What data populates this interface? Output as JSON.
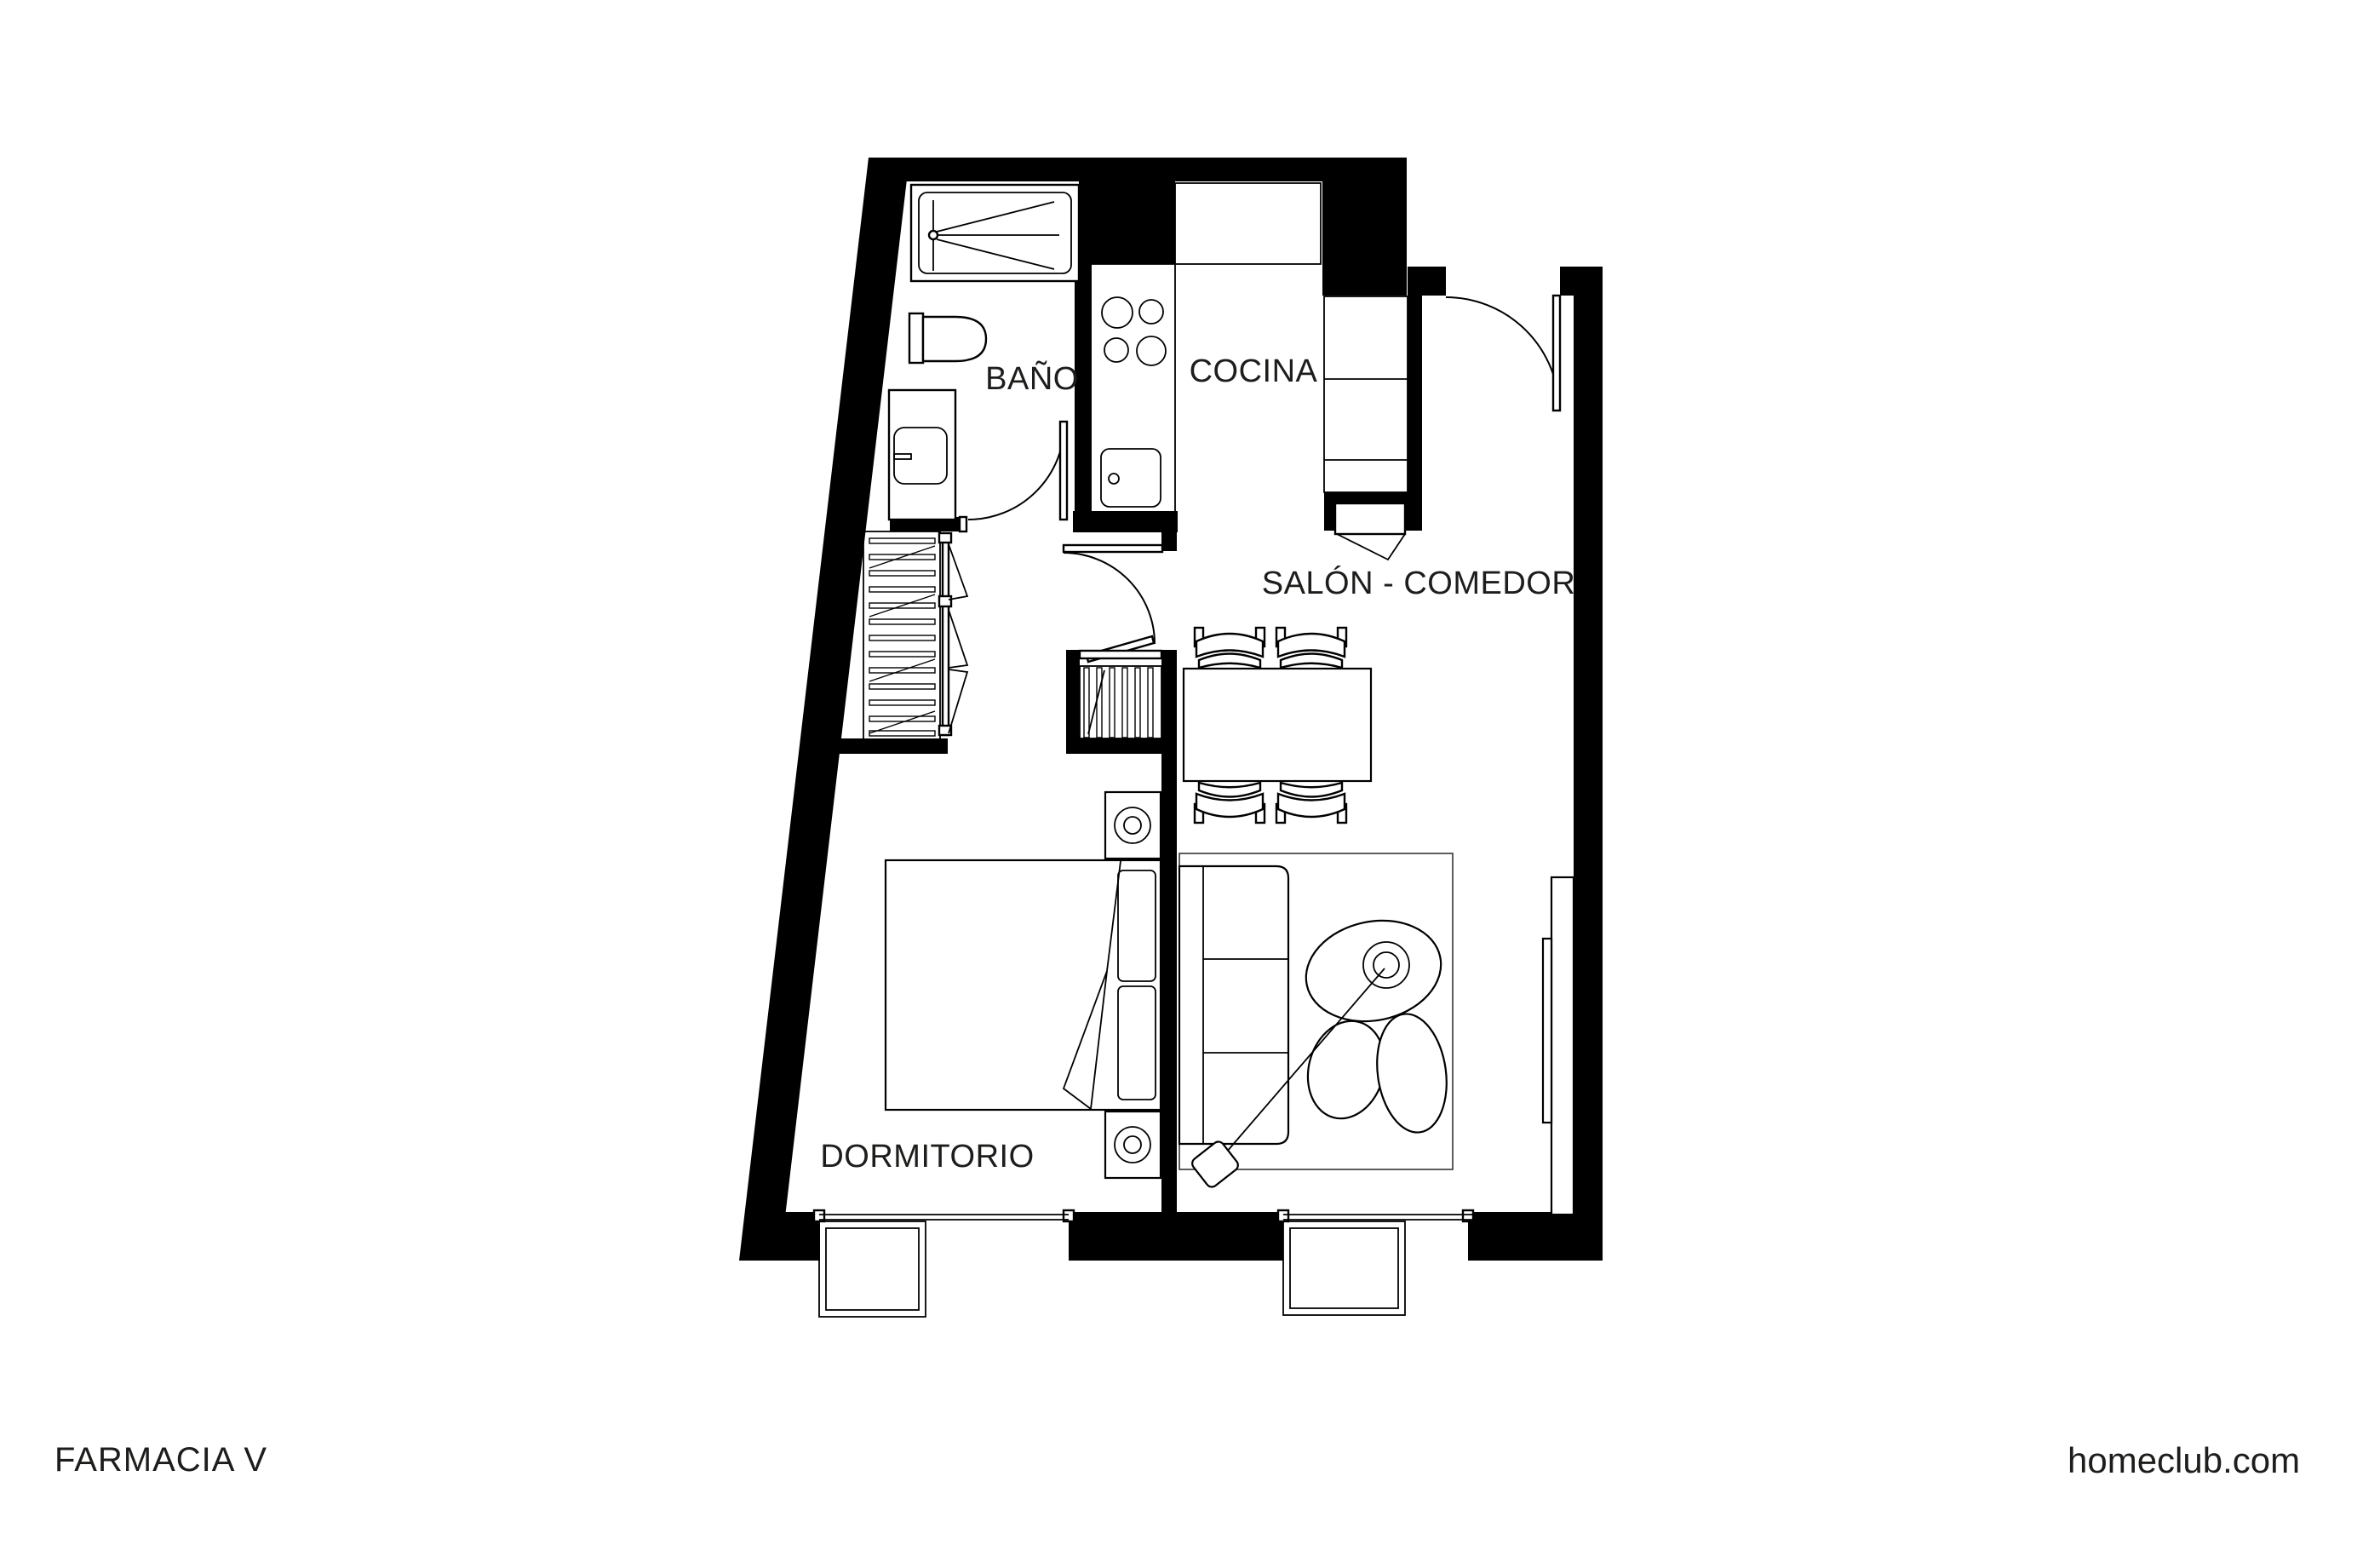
{
  "page": {
    "background": "#ffffff",
    "wall_color": "#000000",
    "line_color": "#1a1a1a",
    "text_color": "#1d1d1b"
  },
  "plan": {
    "type": "apartment-floor-plan",
    "rooms": [
      {
        "id": "bathroom",
        "label": "BAÑO"
      },
      {
        "id": "kitchen",
        "label": "COCINA"
      },
      {
        "id": "living_dining",
        "label": "SALÓN - COMEDOR"
      },
      {
        "id": "bedroom",
        "label": "DORMITORIO"
      }
    ],
    "furniture": [
      "shower-tray",
      "toilet",
      "vanity-sink",
      "hob-4-burners",
      "kitchen-sink",
      "fridge-cabinet-row",
      "tall-kitchen-units",
      "washer",
      "entry-door",
      "bathroom-door",
      "hall-door",
      "folding-wardrobe",
      "louver-closet",
      "dining-table",
      "dining-chairs-x4",
      "double-bed",
      "pillows",
      "nightstands-with-lamps",
      "sofa",
      "rug",
      "plant",
      "arc-floor-lamp",
      "tv-sideboard",
      "bedroom-window",
      "living-window"
    ]
  },
  "footer": {
    "project": "FARMACIA V",
    "website": "homeclub.com"
  }
}
